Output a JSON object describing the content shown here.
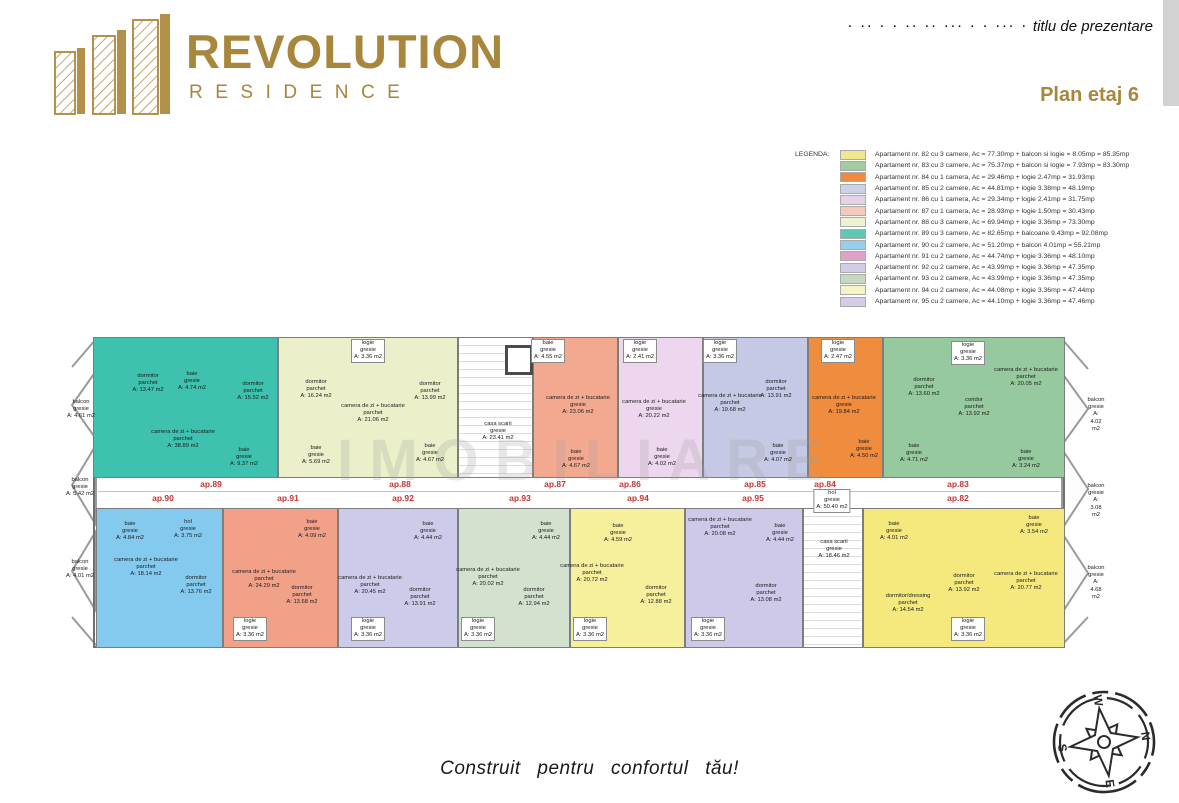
{
  "header": {
    "brand_line1": "REVOLUTION",
    "brand_line2": "RESIDENCE",
    "placeholder_dashes": "· ·· · · ·· ·· ··· · · ··· ·",
    "placeholder_title": "titlu de prezentare",
    "plan_title": "Plan etaj 6",
    "brand_color": "#a8863c"
  },
  "legend": {
    "label": "LEGENDA:",
    "items": [
      {
        "color": "#f1e88e",
        "text": "Apartament nr. 82 cu 3 camere, Ac = 77.30mp + balcon si logie = 8.05mp = 85.35mp"
      },
      {
        "color": "#a3cba3",
        "text": "Apartament nr. 83 cu 3 camere, Ac = 75.37mp + balcon si logie = 7.93mp = 83.30mp"
      },
      {
        "color": "#f08a40",
        "text": "Apartament nr. 84 cu 1 camera, Ac = 29.46mp + logie 2.47mp = 31.93mp"
      },
      {
        "color": "#ccd2e8",
        "text": "Apartament nr. 85 cu 2 camere, Ac = 44.81mp + logie 3.38mp = 48.19mp"
      },
      {
        "color": "#e6d2e6",
        "text": "Apartament nr. 86 cu 1 camera, Ac = 29.34mp + logie 2.41mp = 31.75mp"
      },
      {
        "color": "#f8c8ba",
        "text": "Apartament nr. 87 cu 1 camera, Ac = 28.93mp + logie 1.50mp = 30.43mp"
      },
      {
        "color": "#eef2d0",
        "text": "Apartament nr. 88 cu 3 camere, Ac = 69.94mp + logie 3.36mp = 73.30mp"
      },
      {
        "color": "#5ec7b4",
        "text": "Apartament nr. 89 cu 3 camere, Ac = 82.65mp + balcoane 9.43mp = 92.08mp"
      },
      {
        "color": "#96cfea",
        "text": "Apartament nr. 90 cu 2 camere, Ac = 51.20mp + balcon 4.01mp = 55.21mp"
      },
      {
        "color": "#dda2c6",
        "text": "Apartament nr. 91 cu 2 camere, Ac = 44.74mp + logie 3.36mp = 48.10mp"
      },
      {
        "color": "#d0cde9",
        "text": "Apartament nr. 92 cu 2 camere, Ac = 43.99mp + logie 3.36mp = 47.35mp"
      },
      {
        "color": "#c6d8c2",
        "text": "Apartament nr. 93 cu 2 camere, Ac = 43.99mp + logie 3.36mp = 47.35mp"
      },
      {
        "color": "#f7f4c4",
        "text": "Apartament nr. 94 cu 2 camere, Ac = 44.08mp + logie 3.36mp = 47.44mp"
      },
      {
        "color": "#d2cce7",
        "text": "Apartament nr. 95 cu 2 camere, Ac = 44.10mp + logie 3.36mp = 47.46mp"
      }
    ]
  },
  "plan": {
    "watermark": "IMOBILIARE",
    "apartments": [
      {
        "id": "89",
        "color": "#3ec1ae",
        "x": 25,
        "y": 0,
        "w": 185,
        "h": 141
      },
      {
        "id": "88",
        "color": "#ebf0ca",
        "x": 210,
        "y": 0,
        "w": 180,
        "h": 141
      },
      {
        "id": "stairs-top",
        "color": "#ffffff",
        "x": 390,
        "y": 0,
        "w": 75,
        "h": 141,
        "stairs": true
      },
      {
        "id": "87",
        "color": "#f3a98f",
        "x": 465,
        "y": 0,
        "w": 85,
        "h": 141
      },
      {
        "id": "86",
        "color": "#ecd7ee",
        "x": 550,
        "y": 0,
        "w": 85,
        "h": 141
      },
      {
        "id": "85",
        "color": "#c6c9e6",
        "x": 635,
        "y": 0,
        "w": 105,
        "h": 141
      },
      {
        "id": "84",
        "color": "#f08c3e",
        "x": 740,
        "y": 0,
        "w": 75,
        "h": 141
      },
      {
        "id": "83",
        "color": "#96c99e",
        "x": 815,
        "y": 0,
        "w": 182,
        "h": 141
      },
      {
        "id": "90",
        "color": "#84caee",
        "x": 28,
        "y": 171,
        "w": 127,
        "h": 140
      },
      {
        "id": "91",
        "color": "#f2a189",
        "x": 155,
        "y": 171,
        "w": 115,
        "h": 140
      },
      {
        "id": "92",
        "color": "#cccbe9",
        "x": 270,
        "y": 171,
        "w": 120,
        "h": 140
      },
      {
        "id": "93",
        "color": "#d3e2cf",
        "x": 390,
        "y": 171,
        "w": 112,
        "h": 140
      },
      {
        "id": "94",
        "color": "#f6ef9b",
        "x": 502,
        "y": 171,
        "w": 115,
        "h": 140
      },
      {
        "id": "95",
        "color": "#cfc9e9",
        "x": 617,
        "y": 171,
        "w": 118,
        "h": 140
      },
      {
        "id": "stairs-bottom",
        "color": "#ffffff",
        "x": 735,
        "y": 171,
        "w": 60,
        "h": 140,
        "stairs": true
      },
      {
        "id": "82",
        "color": "#f5e97e",
        "x": 795,
        "y": 171,
        "w": 202,
        "h": 140
      }
    ],
    "corridor_labels": [
      {
        "text": "ap.89",
        "x": 143,
        "y": 142
      },
      {
        "text": "ap.88",
        "x": 332,
        "y": 142
      },
      {
        "text": "ap.87",
        "x": 487,
        "y": 142
      },
      {
        "text": "ap.86",
        "x": 562,
        "y": 142
      },
      {
        "text": "ap.85",
        "x": 687,
        "y": 142
      },
      {
        "text": "ap.84",
        "x": 757,
        "y": 142
      },
      {
        "text": "ap.83",
        "x": 890,
        "y": 142
      },
      {
        "text": "ap.90",
        "x": 95,
        "y": 156
      },
      {
        "text": "ap.91",
        "x": 220,
        "y": 156
      },
      {
        "text": "ap.92",
        "x": 335,
        "y": 156
      },
      {
        "text": "ap.93",
        "x": 452,
        "y": 156
      },
      {
        "text": "ap.94",
        "x": 570,
        "y": 156
      },
      {
        "text": "ap.95",
        "x": 685,
        "y": 156
      },
      {
        "text": "ap.82",
        "x": 890,
        "y": 156
      }
    ],
    "room_labels": [
      {
        "t": "dormitor\nparchet\nA: 13.47 m2",
        "x": 80,
        "y": 36
      },
      {
        "t": "baie\ngresie\nA: 4.74 m2",
        "x": 124,
        "y": 34
      },
      {
        "t": "dormitor\nparchet\nA: 15.52 m2",
        "x": 185,
        "y": 44
      },
      {
        "t": "camera de zi + bucatarie\nparchet\nA: 38.89 m2",
        "x": 115,
        "y": 92
      },
      {
        "t": "baie\ngresie\nA: 9.37 m2",
        "x": 176,
        "y": 110
      },
      {
        "t": "dormitor\nparchet\nA: 16.24 m2",
        "x": 248,
        "y": 42
      },
      {
        "t": "baie\ngresie\nA: 5.69 m2",
        "x": 248,
        "y": 108
      },
      {
        "t": "logie\ngresie\nA: 3.36 m2",
        "x": 300,
        "y": 2,
        "b": 1
      },
      {
        "t": "camera de zi + bucatarie\nparchet\nA: 21.06 m2",
        "x": 305,
        "y": 66
      },
      {
        "t": "dormitor\nparchet\nA: 13.99 m2",
        "x": 362,
        "y": 44
      },
      {
        "t": "baie\ngresie\nA: 4.67 m2",
        "x": 362,
        "y": 106
      },
      {
        "t": "casa scarii\ngresie\nA: 23.41 m2",
        "x": 430,
        "y": 84
      },
      {
        "t": "baie\ngresie\nA: 4.55 m2",
        "x": 480,
        "y": 2,
        "b": 1
      },
      {
        "t": "camera de zi + bucatarie\ngresie\nA: 23.06 m2",
        "x": 510,
        "y": 58
      },
      {
        "t": "baie\ngresie\nA: 4.67 m2",
        "x": 508,
        "y": 112
      },
      {
        "t": "logie\ngresie\nA: 2.41 m2",
        "x": 572,
        "y": 2,
        "b": 1
      },
      {
        "t": "camera de zi + bucatarie\ngresie\nA: 20.22 m2",
        "x": 586,
        "y": 62
      },
      {
        "t": "baie\ngresie\nA: 4.02 m2",
        "x": 594,
        "y": 110
      },
      {
        "t": "logie\ngresie\nA: 3.36 m2",
        "x": 652,
        "y": 2,
        "b": 1
      },
      {
        "t": "camera de zi + bucatarie\nparchet\nA: 19.68 m2",
        "x": 662,
        "y": 56
      },
      {
        "t": "dormitor\nparchet\nA: 13.91 m2",
        "x": 708,
        "y": 42
      },
      {
        "t": "baie\ngresie\nA: 4.07 m2",
        "x": 710,
        "y": 106
      },
      {
        "t": "logie\ngresie\nA: 2.47 m2",
        "x": 770,
        "y": 2,
        "b": 1
      },
      {
        "t": "camera de zi + bucatarie\ngresie\nA: 19.84 m2",
        "x": 776,
        "y": 58
      },
      {
        "t": "baie\ngresie\nA: 4.50 m2",
        "x": 796,
        "y": 102
      },
      {
        "t": "dormitor\nparchet\nA: 13.60 m2",
        "x": 856,
        "y": 40
      },
      {
        "t": "logie\ngresie\nA: 3.36 m2",
        "x": 900,
        "y": 4,
        "b": 1
      },
      {
        "t": "coridor\nparchet\nA: 13.92 m2",
        "x": 906,
        "y": 60
      },
      {
        "t": "camera de zi + bucatarie\nparchet\nA: 20.05 m2",
        "x": 958,
        "y": 30
      },
      {
        "t": "baie\ngresie\nA: 4.71 m2",
        "x": 846,
        "y": 106
      },
      {
        "t": "baie\ngresie\nA: 3.24 m2",
        "x": 958,
        "y": 112
      },
      {
        "t": "balcon\ngresie\nA: 4.61 m2",
        "x": 13,
        "y": 62
      },
      {
        "t": "balcon\ngresie\nA: 5.42 m2",
        "x": 12,
        "y": 140
      },
      {
        "t": "balcon\ngresie\nA: 4.01 m2",
        "x": 12,
        "y": 222
      },
      {
        "t": "balcon\ngresie\nA: 4.02 m2",
        "x": 1028,
        "y": 60
      },
      {
        "t": "balcon\ngresie\nA: 3.08 m2",
        "x": 1028,
        "y": 146
      },
      {
        "t": "balcon\ngresie\nA: 4.68 m2",
        "x": 1028,
        "y": 228
      },
      {
        "t": "hol\ngresie\nA: 50.40 m2",
        "x": 764,
        "y": 152,
        "b": 1
      },
      {
        "t": "casa scarii\ngresie\nA: 18.46 m2",
        "x": 766,
        "y": 202
      },
      {
        "t": "baie\ngresie\nA: 4.84 m2",
        "x": 62,
        "y": 184
      },
      {
        "t": "hol\ngresie\nA: 3.75 m2",
        "x": 120,
        "y": 182
      },
      {
        "t": "camera de zi + bucatarie\nparchet\nA: 18.14 m2",
        "x": 78,
        "y": 220
      },
      {
        "t": "dormitor\nparchet\nA: 13.76 m2",
        "x": 128,
        "y": 238
      },
      {
        "t": "baie\ngresie\nA: 4.09 m2",
        "x": 244,
        "y": 182
      },
      {
        "t": "camera de zi + bucatarie\nparchet\nA: 24.29 m2",
        "x": 196,
        "y": 232
      },
      {
        "t": "dormitor\nparchet\nA: 13.68 m2",
        "x": 234,
        "y": 248
      },
      {
        "t": "logie\ngresie\nA: 3.36 m2",
        "x": 182,
        "y": 280,
        "b": 1
      },
      {
        "t": "baie\ngresie\nA: 4.44 m2",
        "x": 360,
        "y": 184
      },
      {
        "t": "camera de zi + bucatarie\nparchet\nA: 20.45 m2",
        "x": 302,
        "y": 238
      },
      {
        "t": "dormitor\nparchet\nA: 13.91 m2",
        "x": 352,
        "y": 250
      },
      {
        "t": "logie\ngresie\nA: 3.36 m2",
        "x": 300,
        "y": 280,
        "b": 1
      },
      {
        "t": "baie\ngresie\nA: 4.44 m2",
        "x": 478,
        "y": 184
      },
      {
        "t": "camera de zi + bucatarie\nparchet\nA: 20.02 m2",
        "x": 420,
        "y": 230
      },
      {
        "t": "dormitor\nparchet\nA: 12.94 m2",
        "x": 466,
        "y": 250
      },
      {
        "t": "logie\ngresie\nA: 3.36 m2",
        "x": 410,
        "y": 280,
        "b": 1
      },
      {
        "t": "baie\ngresie\nA: 4.59 m2",
        "x": 550,
        "y": 186
      },
      {
        "t": "camera de zi + bucatarie\nparchet\nA: 20.72 m2",
        "x": 524,
        "y": 226
      },
      {
        "t": "dormitor\nparchet\nA: 12.88 m2",
        "x": 588,
        "y": 248
      },
      {
        "t": "logie\ngresie\nA: 3.36 m2",
        "x": 522,
        "y": 280,
        "b": 1
      },
      {
        "t": "camera de zi + bucatarie\nparchet\nA: 20.08 m2",
        "x": 652,
        "y": 180
      },
      {
        "t": "baie\ngresie\nA: 4.44 m2",
        "x": 712,
        "y": 186
      },
      {
        "t": "dormitor\nparchet\nA: 13.08 m2",
        "x": 698,
        "y": 246
      },
      {
        "t": "logie\ngresie\nA: 3.36 m2",
        "x": 640,
        "y": 280,
        "b": 1
      },
      {
        "t": "baie\ngresie\nA: 4.01 m2",
        "x": 826,
        "y": 184
      },
      {
        "t": "baie\ngresie\nA: 3.54 m2",
        "x": 966,
        "y": 178
      },
      {
        "t": "dormitor\nparchet\nA: 13.92 m2",
        "x": 896,
        "y": 236
      },
      {
        "t": "dormitor/dressing\nparchet\nA: 14.54 m2",
        "x": 840,
        "y": 256
      },
      {
        "t": "camera de zi + bucatarie\nparchet\nA: 20.77 m2",
        "x": 958,
        "y": 234
      },
      {
        "t": "logie\ngresie\nA: 3.36 m2",
        "x": 900,
        "y": 280,
        "b": 1
      }
    ]
  },
  "footer": {
    "tagline": "Construit pentru confortul tău!"
  },
  "compass": {
    "n": "N",
    "e": "E",
    "s": "S",
    "w": "W"
  }
}
